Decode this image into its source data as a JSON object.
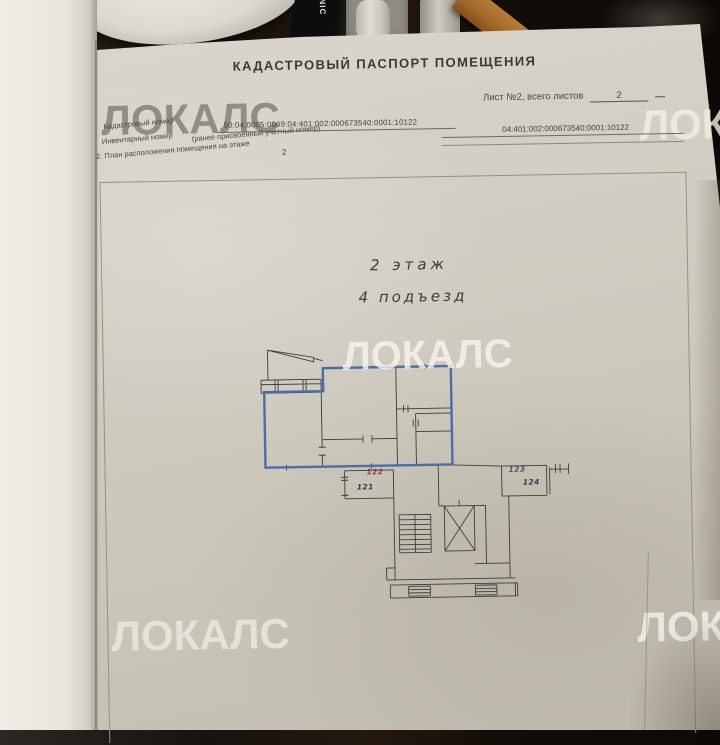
{
  "document": {
    "title": "КАДАСТРОВЫЙ ПАСПОРТ ПОМЕЩЕНИЯ",
    "sheet_info": {
      "label": "Лист №2, всего листов",
      "value": "2"
    },
    "fields": [
      {
        "label": "Кадастровый номер",
        "value": "50:04:0005:0009:04:401:002:000673540:0001:10122"
      },
      {
        "label": "Инвентарный номер",
        "note": "(ранее присвоенный учетный номер)",
        "value": "04:401:002:000673540:0001:10122"
      },
      {
        "label": "2. План расположения помещения на этаже",
        "value": "2"
      }
    ],
    "plan": {
      "floor_label": "2 этаж",
      "entrance_label": "4 подъезд",
      "outline_color": "#4a6ea8",
      "line_color": "#3f3d38",
      "rooms": [
        {
          "number": "122",
          "color": "#b23130"
        },
        {
          "number": "121",
          "color": "#31384a"
        },
        {
          "number": "123",
          "color": "#41567e"
        },
        {
          "number": "124",
          "color": "#343a48"
        }
      ]
    }
  },
  "watermark": {
    "text": "ЛОКАЛС"
  },
  "background": {
    "bottle_text": "NIC"
  }
}
